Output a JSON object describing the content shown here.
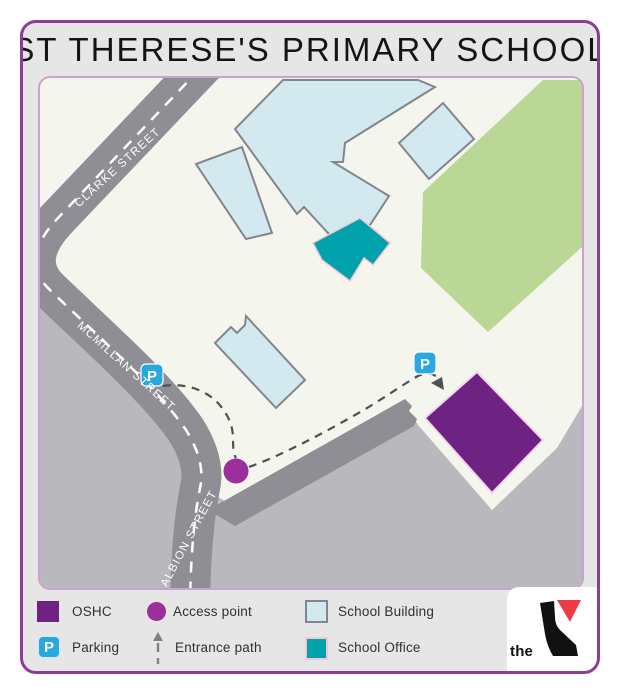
{
  "title": "ST THERESE'S PRIMARY SCHOOL",
  "map": {
    "streets": {
      "clarke": "CLARKE STREET",
      "mcmillan": "MCMILLAN STREET",
      "albion": "ALBION STREET"
    },
    "parking_letter": "P"
  },
  "legend": {
    "oshc": "OSHC",
    "parking": "Parking",
    "access_point": "Access point",
    "entrance_path": "Entrance path",
    "school_building": "School Building",
    "school_office": "School Office"
  },
  "logo": {
    "the": "the"
  },
  "colors": {
    "frame_border": "#8e3d96",
    "frame_bg": "#e7e6e7",
    "map_border": "#cf9fd3",
    "map_bg": "#f4f6ed",
    "road": "#8e8e94",
    "road_dash": "#ffffff",
    "offsite_gray": "#b9b9bd",
    "school_building": "#d2e9ef",
    "building_outline": "#84848c",
    "school_office": "#00a2ad",
    "office_outline": "#f6c6d2",
    "green_space": "#bad796",
    "oshc": "#6e2383",
    "oshc_outline": "#eed9ea",
    "access_point": "#9b2f9b",
    "parking": "#29a7e0",
    "entrance_path": "#4d5154",
    "street_text": "#ffffff",
    "logo_black": "#111111",
    "logo_red": "#ee3a43"
  }
}
